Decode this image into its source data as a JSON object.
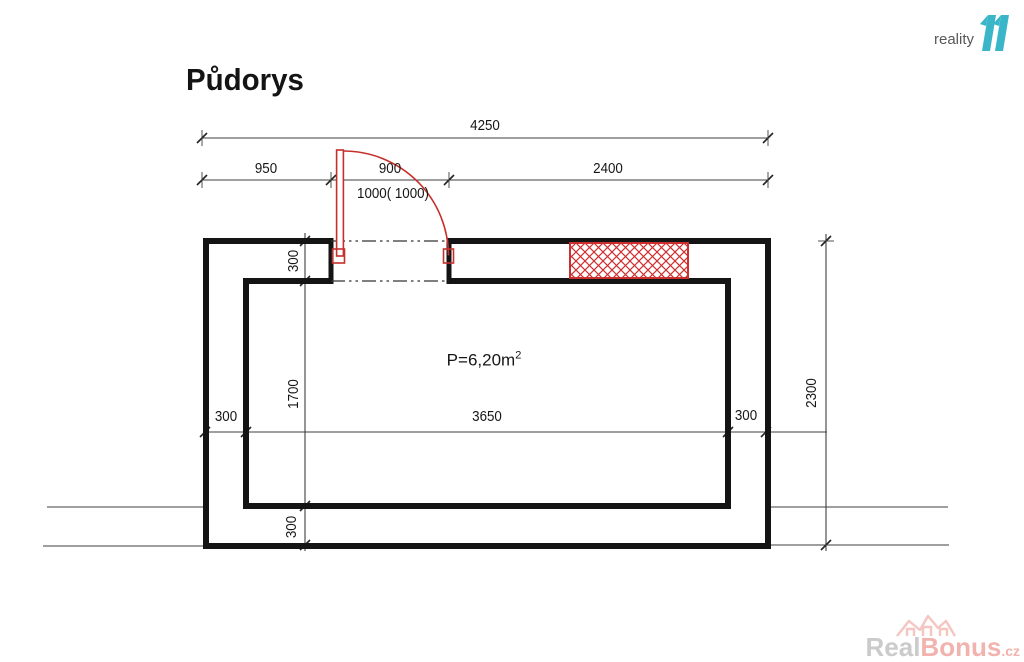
{
  "title": "Půdorys",
  "logo": {
    "name": "reality",
    "mark": "11"
  },
  "area": {
    "prefix": "P=6,20m",
    "sup": "2"
  },
  "dims": {
    "total_top": "4250",
    "seg_left": "950",
    "seg_door": "900",
    "seg_right": "2400",
    "door_spec": "1000( 1000)",
    "wall_top": "300",
    "room_height": "1700",
    "wall_bottom": "300",
    "wall_left": "300",
    "room_width": "3650",
    "wall_right": "300",
    "total_right": "2300"
  },
  "watermark": {
    "part1": "Real",
    "part2": "Bonus",
    "part3": ".cz"
  },
  "colors": {
    "wall": "#141414",
    "dim_line": "#3f3f3f",
    "red": "#c5302b",
    "teal": "#3ab6c8"
  }
}
